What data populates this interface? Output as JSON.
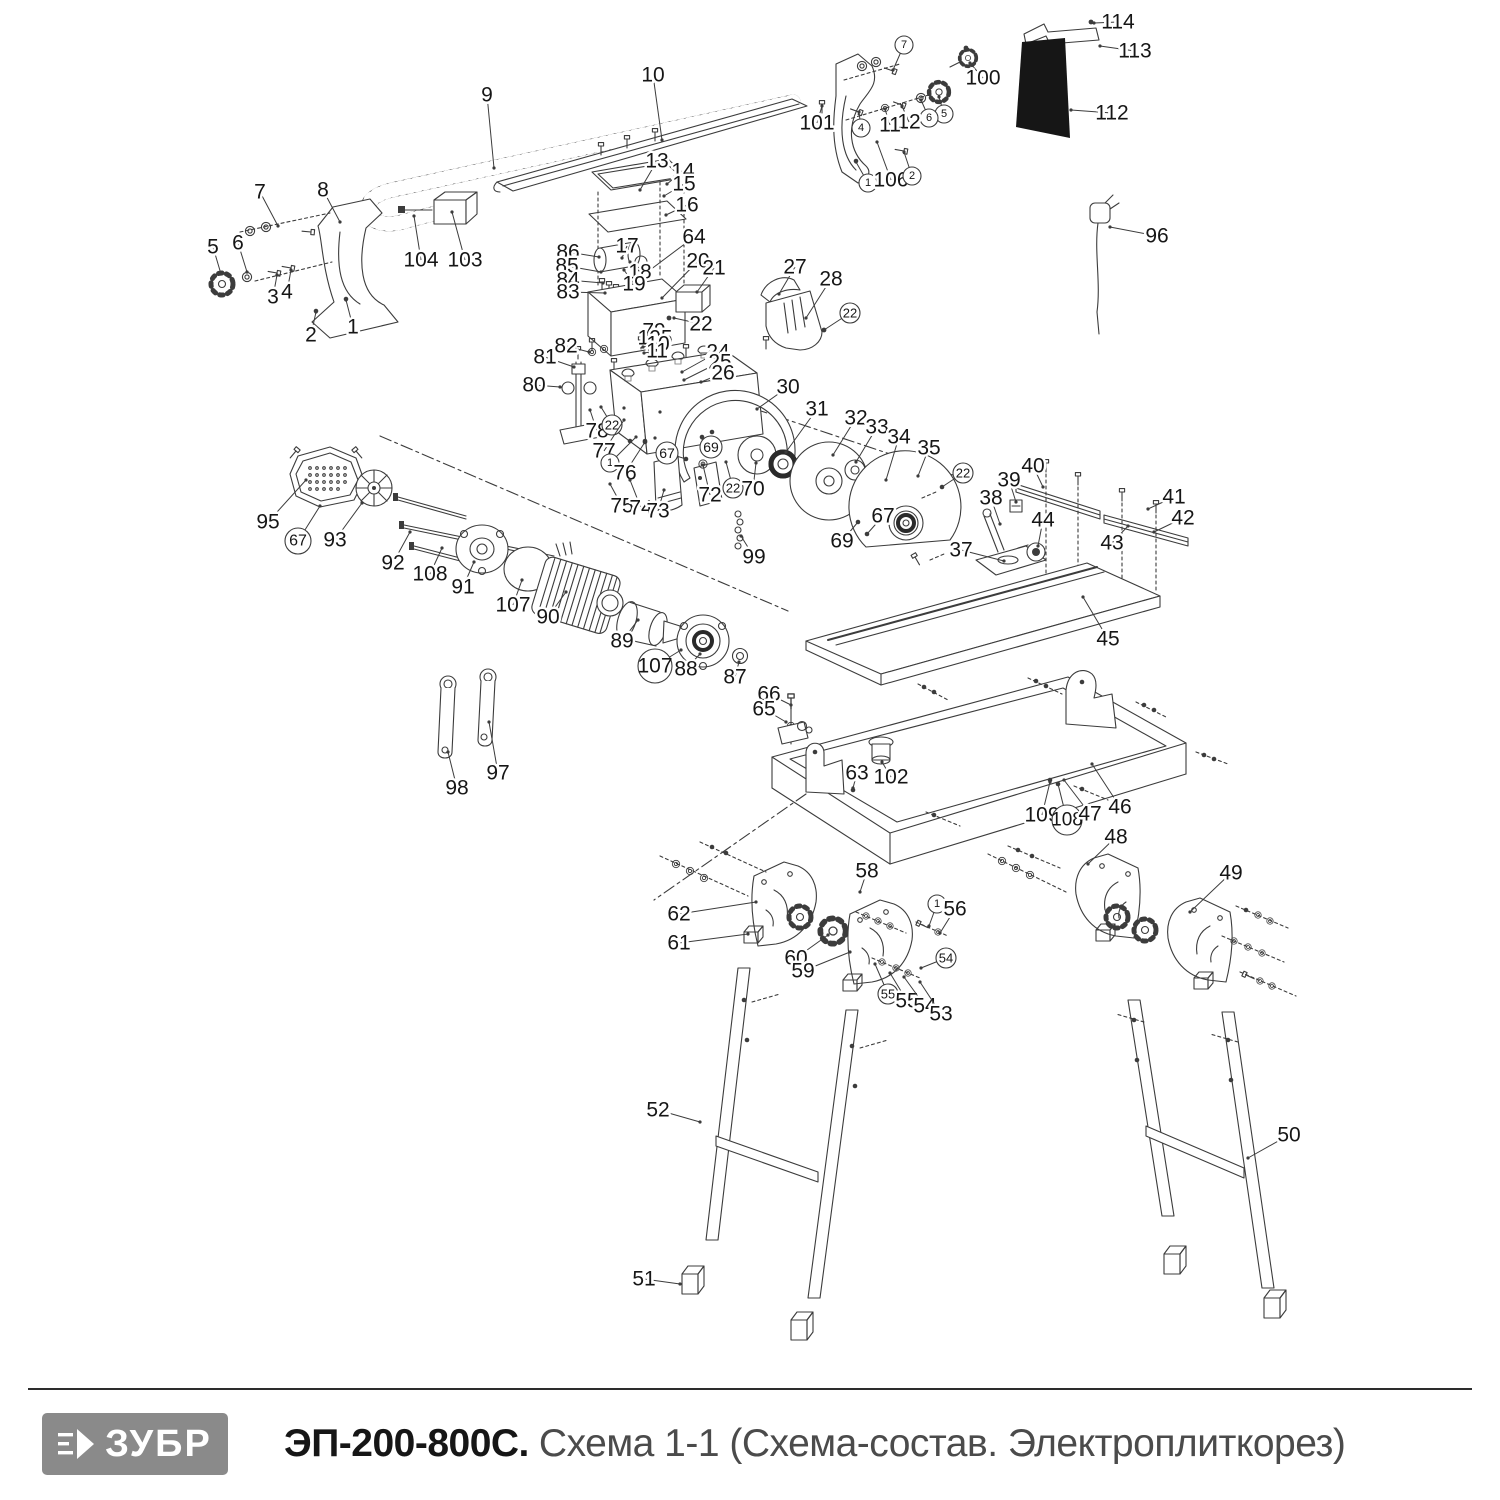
{
  "footer": {
    "brand": "ЗУБР",
    "model": "ЭП-200-800С.",
    "subtitle": "Схема 1-1 (Схема-состав. Электроплиткорез)"
  },
  "colors": {
    "line": "#3c3c3c",
    "label": "#161616",
    "logo_bg": "#8a8a8a",
    "panel_black": "#161616",
    "subtitle_gray": "#4b4b4b"
  },
  "diagram": {
    "callouts": [
      {
        "t": "9",
        "x": 487,
        "y": 95,
        "lx": 494,
        "ly": 168
      },
      {
        "t": "10",
        "x": 653,
        "y": 75,
        "lx": 662,
        "ly": 140
      },
      {
        "t": "7",
        "x": 260,
        "y": 192,
        "lx": 278,
        "ly": 226
      },
      {
        "t": "8",
        "x": 323,
        "y": 190,
        "lx": 340,
        "ly": 222
      },
      {
        "t": "5",
        "x": 213,
        "y": 247,
        "lx": 221,
        "ly": 274
      },
      {
        "t": "6",
        "x": 238,
        "y": 243,
        "lx": 247,
        "ly": 272
      },
      {
        "t": "3",
        "x": 273,
        "y": 297,
        "lx": 277,
        "ly": 275
      },
      {
        "t": "4",
        "x": 287,
        "y": 292,
        "lx": 291,
        "ly": 270
      },
      {
        "t": "2",
        "x": 311,
        "y": 335,
        "lx": 316,
        "ly": 312
      },
      {
        "t": "1",
        "x": 353,
        "y": 327,
        "lx": 346,
        "ly": 300
      },
      {
        "t": "104",
        "x": 421,
        "y": 260,
        "lx": 414,
        "ly": 216
      },
      {
        "t": "103",
        "x": 465,
        "y": 260,
        "lx": 452,
        "ly": 212
      },
      {
        "t": "13",
        "x": 657,
        "y": 161,
        "lx": 640,
        "ly": 190
      },
      {
        "t": "14",
        "x": 683,
        "y": 171,
        "lx": 667,
        "ly": 184
      },
      {
        "t": "15",
        "x": 684,
        "y": 184,
        "lx": 664,
        "ly": 196
      },
      {
        "t": "16",
        "x": 687,
        "y": 205,
        "lx": 666,
        "ly": 215
      },
      {
        "t": "64",
        "x": 694,
        "y": 237,
        "lx": 650,
        "ly": 270
      },
      {
        "t": "17",
        "x": 627,
        "y": 246,
        "lx": 622,
        "ly": 258
      },
      {
        "t": "18",
        "x": 640,
        "y": 272,
        "lx": 630,
        "ly": 262
      },
      {
        "t": "19",
        "x": 634,
        "y": 284,
        "lx": 624,
        "ly": 270
      },
      {
        "t": "20",
        "x": 698,
        "y": 261,
        "lx": 662,
        "ly": 298
      },
      {
        "t": "21",
        "x": 714,
        "y": 268,
        "lx": 697,
        "ly": 292
      },
      {
        "t": "22",
        "x": 701,
        "y": 324,
        "lx": 674,
        "ly": 318
      },
      {
        "t": "86",
        "x": 568,
        "y": 252,
        "lx": 599,
        "ly": 257
      },
      {
        "t": "85",
        "x": 567,
        "y": 266,
        "lx": 601,
        "ly": 272
      },
      {
        "t": "84",
        "x": 568,
        "y": 280,
        "lx": 603,
        "ly": 283
      },
      {
        "t": "83",
        "x": 568,
        "y": 292,
        "lx": 605,
        "ly": 293
      },
      {
        "t": "79",
        "x": 654,
        "y": 331,
        "fs": 12,
        "lx": 641,
        "ly": 334
      },
      {
        "t": "105",
        "x": 655,
        "y": 338,
        "fs": 12,
        "lx": 642,
        "ly": 341
      },
      {
        "t": "10",
        "x": 658,
        "y": 344,
        "fs": 12,
        "lx": 643,
        "ly": 347
      },
      {
        "t": "11",
        "x": 657,
        "y": 351,
        "fs": 12,
        "lx": 644,
        "ly": 353
      },
      {
        "t": "82",
        "x": 566,
        "y": 346,
        "lx": 589,
        "ly": 352
      },
      {
        "t": "81",
        "x": 545,
        "y": 357,
        "lx": 574,
        "ly": 367
      },
      {
        "t": "80",
        "x": 534,
        "y": 385,
        "lx": 560,
        "ly": 387
      },
      {
        "t": "24",
        "x": 718,
        "y": 352,
        "lx": 682,
        "ly": 372
      },
      {
        "t": "25",
        "x": 720,
        "y": 362,
        "lx": 684,
        "ly": 380
      },
      {
        "t": "26",
        "x": 723,
        "y": 373,
        "lx": 701,
        "ly": 382
      },
      {
        "t": "27",
        "x": 795,
        "y": 267,
        "lx": 779,
        "ly": 294
      },
      {
        "t": "28",
        "x": 831,
        "y": 279,
        "lx": 806,
        "ly": 318
      },
      {
        "t": "22",
        "c": true,
        "r": 10,
        "x": 850,
        "y": 313,
        "lx": 824,
        "ly": 330
      },
      {
        "t": "30",
        "x": 788,
        "y": 387,
        "lx": 757,
        "ly": 409
      },
      {
        "t": "31",
        "x": 817,
        "y": 409,
        "lx": 786,
        "ly": 452
      },
      {
        "t": "32",
        "x": 856,
        "y": 418,
        "lx": 833,
        "ly": 455
      },
      {
        "t": "33",
        "x": 877,
        "y": 427,
        "lx": 856,
        "ly": 462
      },
      {
        "t": "34",
        "x": 899,
        "y": 437,
        "lx": 886,
        "ly": 480
      },
      {
        "t": "35",
        "x": 929,
        "y": 448,
        "lx": 918,
        "ly": 476
      },
      {
        "t": "22",
        "c": true,
        "r": 10,
        "x": 963,
        "y": 473,
        "lx": 942,
        "ly": 487
      },
      {
        "t": "78",
        "x": 597,
        "y": 431,
        "lx": 590,
        "ly": 410
      },
      {
        "t": "22",
        "c": true,
        "r": 10,
        "x": 612,
        "y": 425,
        "lx": 601,
        "ly": 407
      },
      {
        "t": "77",
        "x": 604,
        "y": 451,
        "lx": 624,
        "ly": 420
      },
      {
        "t": "1",
        "c": true,
        "r": 9,
        "x": 610,
        "y": 463,
        "lx": 636,
        "ly": 437
      },
      {
        "t": "76",
        "x": 625,
        "y": 473,
        "lx": 645,
        "ly": 442
      },
      {
        "t": "67",
        "c": true,
        "r": 11,
        "x": 667,
        "y": 453,
        "lx": 686,
        "ly": 459
      },
      {
        "t": "69",
        "c": true,
        "r": 11,
        "x": 711,
        "y": 447,
        "lx": 702,
        "ly": 438
      },
      {
        "t": "75",
        "x": 622,
        "y": 506,
        "lx": 610,
        "ly": 484
      },
      {
        "t": "74",
        "x": 641,
        "y": 508,
        "lx": 630,
        "ly": 480
      },
      {
        "t": "73",
        "x": 658,
        "y": 511,
        "lx": 664,
        "ly": 490
      },
      {
        "t": "72",
        "x": 710,
        "y": 495,
        "lx": 703,
        "ly": 465
      },
      {
        "t": "22",
        "c": true,
        "r": 10,
        "x": 733,
        "y": 488,
        "lx": 726,
        "ly": 462
      },
      {
        "t": "70",
        "x": 753,
        "y": 489,
        "lx": 756,
        "ly": 463
      },
      {
        "t": "99",
        "x": 754,
        "y": 557,
        "lx": 741,
        "ly": 536
      },
      {
        "t": "67",
        "x": 883,
        "y": 516,
        "lx": 867,
        "ly": 534
      },
      {
        "t": "69",
        "x": 842,
        "y": 541,
        "lx": 858,
        "ly": 522
      },
      {
        "t": "37",
        "x": 961,
        "y": 550,
        "lx": 1004,
        "ly": 561
      },
      {
        "t": "38",
        "x": 991,
        "y": 498,
        "lx": 1000,
        "ly": 524
      },
      {
        "t": "39",
        "x": 1009,
        "y": 480,
        "lx": 1016,
        "ly": 502
      },
      {
        "t": "40",
        "x": 1033,
        "y": 466,
        "lx": 1043,
        "ly": 487
      },
      {
        "t": "41",
        "x": 1174,
        "y": 497,
        "lx": 1148,
        "ly": 509
      },
      {
        "t": "42",
        "x": 1183,
        "y": 518,
        "lx": 1154,
        "ly": 532
      },
      {
        "t": "43",
        "x": 1112,
        "y": 543,
        "lx": 1128,
        "ly": 526
      },
      {
        "t": "44",
        "x": 1043,
        "y": 520,
        "lx": 1038,
        "ly": 546
      },
      {
        "t": "45",
        "x": 1108,
        "y": 639,
        "lx": 1083,
        "ly": 597
      },
      {
        "t": "114",
        "x": 1118,
        "y": 22,
        "lx": 1094,
        "ly": 23
      },
      {
        "t": "113",
        "x": 1135,
        "y": 51,
        "lx": 1100,
        "ly": 46
      },
      {
        "t": "112",
        "x": 1112,
        "y": 113,
        "lx": 1071,
        "ly": 110
      },
      {
        "t": "100",
        "x": 983,
        "y": 78,
        "lx": 970,
        "ly": 63
      },
      {
        "t": "101",
        "x": 817,
        "y": 123,
        "lx": 822,
        "ly": 106
      },
      {
        "t": "7",
        "c": true,
        "r": 9,
        "x": 904,
        "y": 45,
        "lx": 893,
        "ly": 70
      },
      {
        "t": "5",
        "c": true,
        "r": 9,
        "x": 944,
        "y": 114,
        "lx": 939,
        "ly": 97
      },
      {
        "t": "6",
        "c": true,
        "r": 9,
        "x": 929,
        "y": 118,
        "lx": 921,
        "ly": 100
      },
      {
        "t": "12",
        "x": 909,
        "y": 122,
        "lx": 902,
        "ly": 106
      },
      {
        "t": "11",
        "x": 890,
        "y": 125,
        "lx": 885,
        "ly": 109
      },
      {
        "t": "4",
        "c": true,
        "r": 9,
        "x": 861,
        "y": 128,
        "lx": 859,
        "ly": 112
      },
      {
        "t": "1",
        "c": true,
        "r": 9,
        "x": 868,
        "y": 183,
        "lx": 856,
        "ly": 162
      },
      {
        "t": "106",
        "x": 891,
        "y": 180,
        "lx": 877,
        "ly": 142
      },
      {
        "t": "2",
        "c": true,
        "r": 9,
        "x": 912,
        "y": 176,
        "lx": 904,
        "ly": 152
      },
      {
        "t": "96",
        "x": 1157,
        "y": 236,
        "lx": 1110,
        "ly": 227
      },
      {
        "t": "95",
        "x": 268,
        "y": 522,
        "lx": 306,
        "ly": 480
      },
      {
        "t": "67",
        "c": true,
        "r": 13,
        "x": 298,
        "y": 541,
        "lx": 320,
        "ly": 506
      },
      {
        "t": "93",
        "x": 335,
        "y": 540,
        "lx": 362,
        "ly": 503
      },
      {
        "t": "92",
        "x": 393,
        "y": 563,
        "lx": 410,
        "ly": 532
      },
      {
        "t": "108",
        "x": 430,
        "y": 574,
        "lx": 442,
        "ly": 548
      },
      {
        "t": "91",
        "x": 463,
        "y": 587,
        "lx": 474,
        "ly": 562
      },
      {
        "t": "107",
        "x": 513,
        "y": 605,
        "lx": 522,
        "ly": 580
      },
      {
        "t": "90",
        "x": 548,
        "y": 617,
        "lx": 566,
        "ly": 592
      },
      {
        "t": "89",
        "x": 622,
        "y": 641,
        "lx": 638,
        "ly": 620
      },
      {
        "t": "107",
        "c": true,
        "r": 17,
        "x": 655,
        "y": 666,
        "lx": 681,
        "ly": 650
      },
      {
        "t": "88",
        "x": 686,
        "y": 669,
        "lx": 700,
        "ly": 654
      },
      {
        "t": "87",
        "x": 735,
        "y": 677,
        "lx": 739,
        "ly": 662
      },
      {
        "t": "98",
        "x": 457,
        "y": 788,
        "lx": 448,
        "ly": 752
      },
      {
        "t": "97",
        "x": 498,
        "y": 773,
        "lx": 489,
        "ly": 722
      },
      {
        "t": "66",
        "x": 769,
        "y": 694,
        "lx": 791,
        "ly": 705
      },
      {
        "t": "65",
        "x": 764,
        "y": 709,
        "lx": 786,
        "ly": 722
      },
      {
        "t": "63",
        "x": 857,
        "y": 773,
        "lx": 853,
        "ly": 788
      },
      {
        "t": "102",
        "x": 891,
        "y": 777,
        "lx": 882,
        "ly": 762
      },
      {
        "t": "109",
        "x": 1042,
        "y": 815,
        "lx": 1050,
        "ly": 782
      },
      {
        "t": "108",
        "c": true,
        "r": 15,
        "x": 1067,
        "y": 820,
        "lx": 1058,
        "ly": 784
      },
      {
        "t": "47",
        "x": 1090,
        "y": 814,
        "lx": 1064,
        "ly": 780
      },
      {
        "t": "46",
        "x": 1120,
        "y": 807,
        "lx": 1092,
        "ly": 764
      },
      {
        "t": "48",
        "x": 1116,
        "y": 837,
        "lx": 1088,
        "ly": 864
      },
      {
        "t": "49",
        "x": 1231,
        "y": 873,
        "lx": 1190,
        "ly": 912
      },
      {
        "t": "62",
        "x": 679,
        "y": 914,
        "lx": 756,
        "ly": 902
      },
      {
        "t": "61",
        "x": 679,
        "y": 943,
        "lx": 748,
        "ly": 934
      },
      {
        "t": "58",
        "x": 867,
        "y": 871,
        "lx": 860,
        "ly": 892
      },
      {
        "t": "60",
        "x": 796,
        "y": 958,
        "lx": 828,
        "ly": 935
      },
      {
        "t": "59",
        "x": 803,
        "y": 971,
        "lx": 850,
        "ly": 952
      },
      {
        "t": "1",
        "c": true,
        "r": 9,
        "x": 937,
        "y": 904,
        "lx": 929,
        "ly": 926
      },
      {
        "t": "56",
        "x": 955,
        "y": 909,
        "lx": 940,
        "ly": 933
      },
      {
        "t": "54",
        "c": true,
        "r": 10,
        "x": 946,
        "y": 958,
        "lx": 921,
        "ly": 968
      },
      {
        "t": "55",
        "c": true,
        "r": 10,
        "x": 888,
        "y": 994,
        "lx": 875,
        "ly": 964
      },
      {
        "t": "55",
        "x": 907,
        "y": 1001,
        "lx": 890,
        "ly": 973
      },
      {
        "t": "54",
        "x": 925,
        "y": 1006,
        "lx": 904,
        "ly": 977
      },
      {
        "t": "53",
        "x": 941,
        "y": 1014,
        "lx": 920,
        "ly": 982
      },
      {
        "t": "52",
        "x": 658,
        "y": 1110,
        "lx": 700,
        "ly": 1122
      },
      {
        "t": "50",
        "x": 1289,
        "y": 1135,
        "lx": 1248,
        "ly": 1158
      },
      {
        "t": "51",
        "x": 644,
        "y": 1279,
        "lx": 680,
        "ly": 1284
      }
    ]
  }
}
